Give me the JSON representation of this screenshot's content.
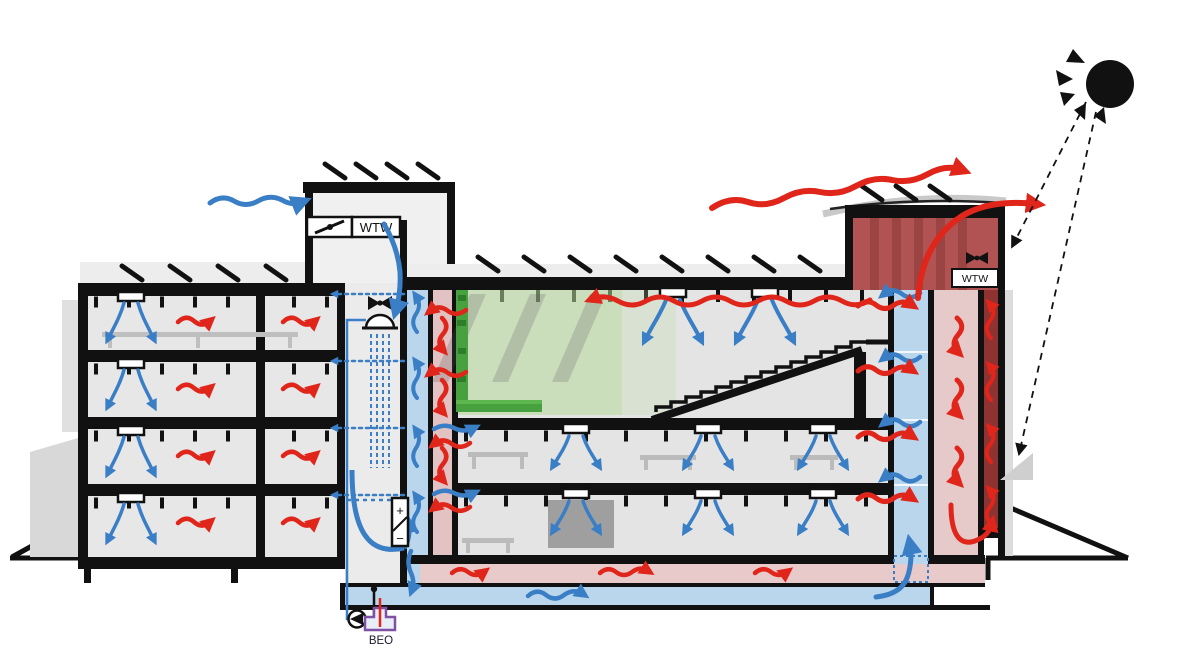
{
  "diagram": {
    "type": "building-section-climate-concept",
    "labels": {
      "wtw_left": "WTW",
      "wtw_right": "WTW",
      "beo": "BEO",
      "hx_plus": "+",
      "hx_minus": "−"
    },
    "icons": [
      "sun-icon",
      "fan-icon-left-tower",
      "fan-icon-solar-chimney",
      "shower-adiabatic-cooling-icon",
      "pump-icon",
      "damper-icon",
      "heat-exchanger-plus-minus",
      "beo-borehole-symbol",
      "solar-panel-marks",
      "green-wall",
      "staircase"
    ],
    "colors": {
      "supply_air_blue": "#3a7ec6",
      "exhaust_air_red": "#e0251b",
      "solar_chimney_dark_red": "#8e3232",
      "solar_chimney_tower_red": "#b15353",
      "warm_cavity_pink": "#e6c9c9",
      "floor_heating_pink": "#e8caca",
      "ground_duct_blue": "#b9d6ec",
      "greenery_green": "#46a13e",
      "green_overlay": "#b7d89a",
      "structure_black": "#111111",
      "building_gray": "#e4e4e4"
    }
  }
}
